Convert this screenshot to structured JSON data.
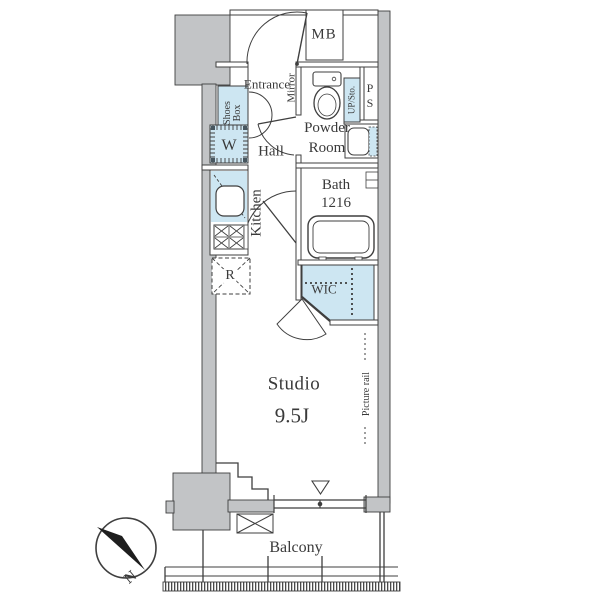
{
  "palette": {
    "wall_fill": "#c2c4c6",
    "fixture_blue": "#cde6f2",
    "line_color": "#3f3f3f",
    "text_color": "#3a3a3a",
    "background": "#ffffff",
    "compass_needle": "#1e1e1e"
  },
  "floor_plan": {
    "labels": {
      "meter_box": "MB",
      "entrance": "Entrance",
      "mirror": "Mirror",
      "shoes_box": [
        "Shoes",
        "Box"
      ],
      "powder_room": [
        "Powder",
        "Room"
      ],
      "up_storage": "UP/Sto.",
      "pipe_space": [
        "P",
        "S"
      ],
      "washer": "W",
      "hall": "Hall",
      "bath": [
        "Bath",
        "1216"
      ],
      "kitchen": "Kitchen",
      "refrigerator": "R",
      "wic": "WIC",
      "studio": "Studio",
      "studio_size": "9.5J",
      "picture_rail": "Picture rail",
      "balcony": "Balcony",
      "compass_north": "N"
    }
  }
}
